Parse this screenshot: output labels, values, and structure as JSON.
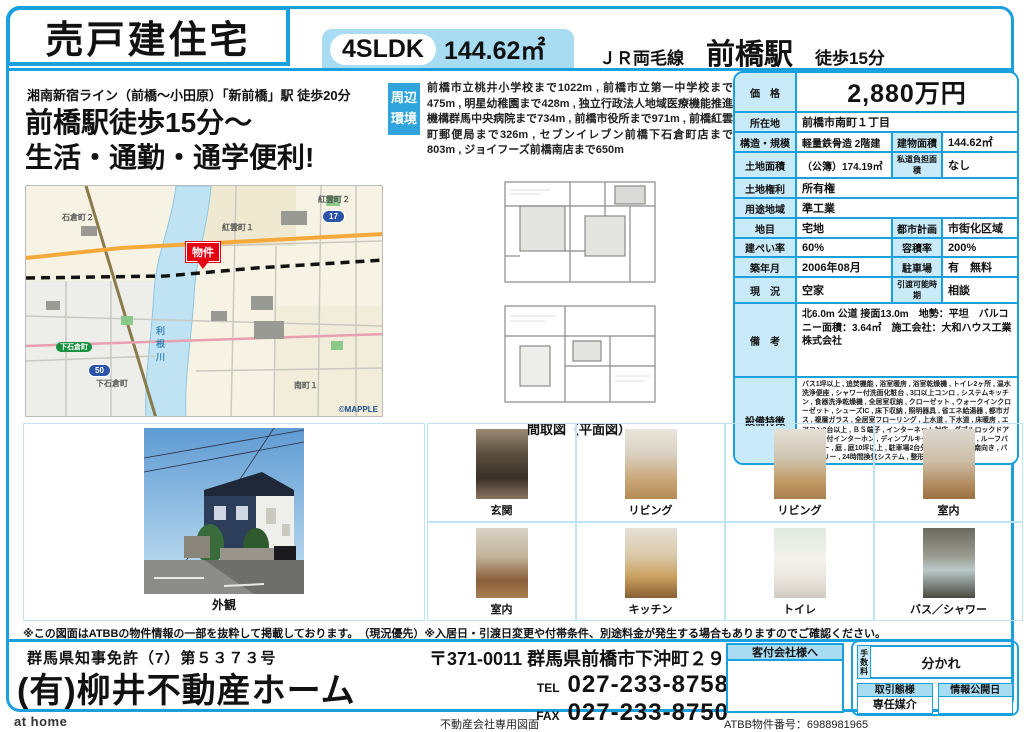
{
  "header": {
    "property_type": "売戸建住宅",
    "layout": "4SLDK",
    "area": "144.62㎡",
    "line": "ＪＲ両毛線",
    "station": "前橋駅",
    "walk": "徒歩15分"
  },
  "catchcopy": {
    "sub": "湘南新宿ライン（前橋～小田原）「新前橋」駅 徒歩20分",
    "line1": "前橋駅徒歩15分～",
    "line2": "生活・通勤・通学便利!"
  },
  "surroundings": {
    "label_line1": "周辺",
    "label_line2": "環境",
    "text": "前橋市立桃井小学校まで1022m , 前橋市立第一中学校まで475m , 明星幼稚園まで428m , 独立行政法人地域医療機能推進機構群馬中央病院まで734m , 前橋市役所まで971m , 前橋紅雲町郵便局まで326m , セブンイレブン前橋下石倉町店まで803m , ジョイフーズ前橋南店まで650m"
  },
  "map": {
    "marker": "物件",
    "credit": "©MAPPLE",
    "river": "利根川",
    "town1": "紅雲町１",
    "town2": "紅雲町２",
    "town3": "石倉町２",
    "town4": "下石倉町",
    "town5": "南町１",
    "road_pill": "下石倉町",
    "shield1": "17",
    "shield2": "50"
  },
  "floorplan": {
    "caption": "間取図（平面図）"
  },
  "details": {
    "price_label": "価　格",
    "price": "2,880万円",
    "location_label": "所在地",
    "location": "前橋市南町１丁目",
    "structure_label": "構造・規模",
    "structure": "軽量鉄骨造 2階建",
    "bldg_area_label": "建物面積",
    "bldg_area": "144.62㎡",
    "land_label": "土地面積",
    "land": "（公簿）174.19㎡",
    "road_label": "私道負担面積",
    "road": "なし",
    "rights_label": "土地権利",
    "rights": "所有権",
    "zoning_label": "用途地域",
    "zoning": "準工業",
    "landcat_label": "地目",
    "landcat": "宅地",
    "cityplan_label": "都市計画",
    "cityplan": "市街化区域",
    "bcr_label": "建ぺい率",
    "bcr": "60%",
    "far_label": "容積率",
    "far": "200%",
    "built_label": "築年月",
    "built": "2006年08月",
    "parking_label": "駐車場",
    "parking": "有　無料",
    "status_label": "現　況",
    "status": "空家",
    "delivery_label": "引渡可能時期",
    "delivery": "相談",
    "notes_label": "備　考",
    "notes": "北6.0m 公道 接面13.0m　地勢：平坦　バルコニー面積：3.64㎡　施工会社：大和ハウス工業株式会社",
    "features_label": "設備特徴",
    "features": "バス1坪以上 , 追焚機能 , 浴室暖房 , 浴室乾燥機 , トイレ2ヶ所 , 温水洗浄便座 , シャワー付洗面化粧台 , 3口以上コンロ , システムキッチン , 食器洗浄乾燥機 , 全居室収納 , クローゼット , ウォークインクローゼット , シューズIC , 床下収納 , 照明器具 , 省エネ給湯器 , 都市ガス , 複層ガラス , 全居室フローリング , 上水道 , 下水道 , 床暖房 , エアコン2台以上 , ＢＳ端子 , インターネット対応 , ダブルロックドア , モニタ付インターホン , ディンプルキー , 防犯用ガラス , ルーフバルコニー , 庭 , 庭10坪以上 , 駐車場2台分 , 主要採光面：南向き , バリアフリー , 24時間換気システム , 整形地…"
  },
  "photos": {
    "exterior_caption": "外観",
    "items": [
      {
        "caption": "玄関"
      },
      {
        "caption": "リビング"
      },
      {
        "caption": "リビング"
      },
      {
        "caption": "室内"
      },
      {
        "caption": "室内"
      },
      {
        "caption": "キッチン"
      },
      {
        "caption": "トイレ"
      },
      {
        "caption": "バス／シャワー"
      }
    ]
  },
  "disclaimer": "※この図面はATBBの物件情報の一部を抜粋して掲載しております。　（現況優先）※入居日・引渡日変更や付帯条件、別途料金が発生する場合もありますのでご確認ください。",
  "bottom": {
    "license": "群馬県知事免許（7）第５３７３号",
    "company": "(有)柳井不動産ホーム",
    "address": "〒371-0011 群馬県前橋市下沖町２９－４",
    "tel_label": "TEL",
    "tel": "027-233-8758",
    "fax_label": "FAX",
    "fax": "027-233-8750",
    "to_agent": "客付会社様へ",
    "fee_label": "手数料",
    "fee_value": "分かれ",
    "deal_label": "取引態様",
    "deal_value": "専任媒介",
    "publish_label": "情報公開日",
    "publish_value": ""
  },
  "footer": {
    "logo": "at home",
    "docnote": "不動産会社専用図面",
    "atbb": "ATBB物件番号：6988981965"
  },
  "colors": {
    "accent_blue": "#1BA0DF",
    "light_blue": "#A8DCF3",
    "table_label_blue": "#C9EAF8",
    "env_label_blue": "#2FA5DB",
    "marker_red": "#E60012"
  }
}
